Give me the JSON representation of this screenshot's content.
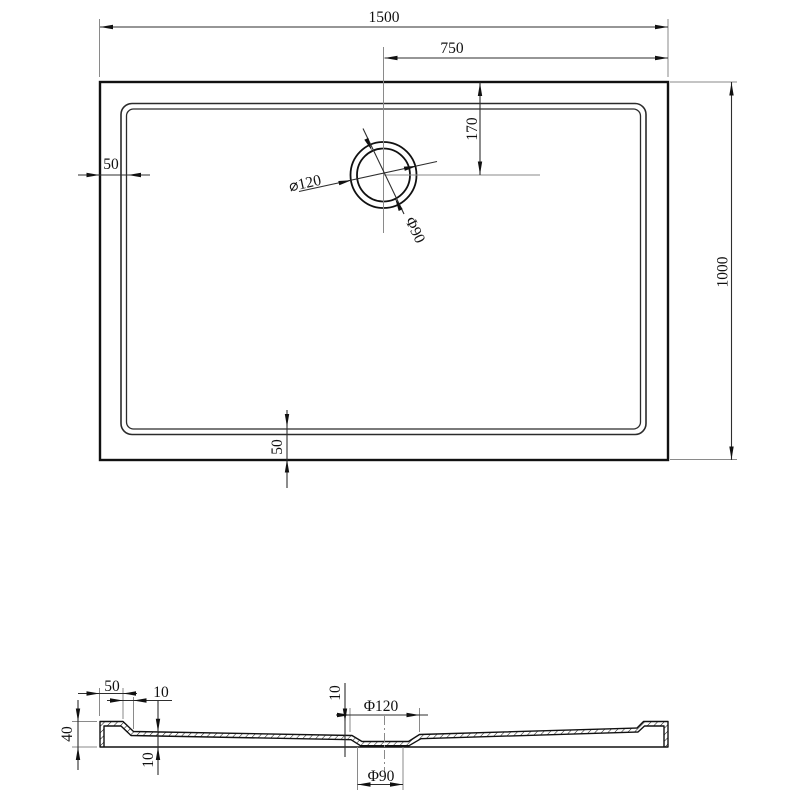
{
  "drawing_type": "shower-tray-technical-drawing",
  "colors": {
    "outline": "#111111",
    "dimension_line": "#2e2e2e",
    "extension_line": "#8a8a8a",
    "background": "#ffffff"
  },
  "plan": {
    "overall_width": "1500",
    "drain_center_from_right": "750",
    "drain_center_from_top": "170",
    "overall_depth": "1000",
    "rim_inset_left": "50",
    "rim_inset_bottom": "50",
    "drain_outer_dia": "⌀120",
    "drain_inner_dia": "Φ90"
  },
  "section": {
    "rim_width": "50",
    "rim_slope_width": "10",
    "edge_height": "40",
    "bottom_thickness": "10",
    "recess_depth": "10",
    "recess_dia": "Φ120",
    "drain_hole_dia": "Φ90"
  }
}
